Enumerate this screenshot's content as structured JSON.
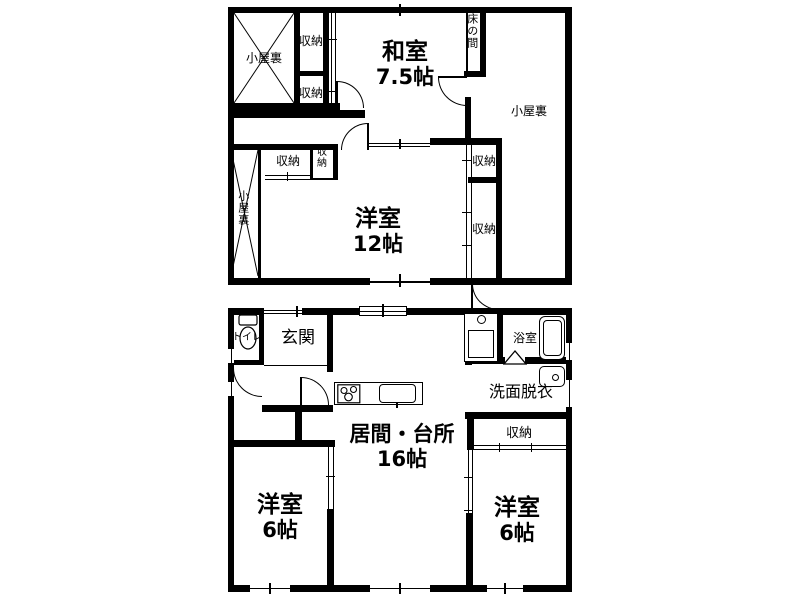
{
  "plan_title": "二階建て住宅間取り図",
  "colors": {
    "line": "#000000",
    "background": "#ffffff"
  },
  "floors": {
    "upper": {
      "attic_top_left": "小屋裏",
      "closet_top_1": "収納",
      "closet_top_2": "収納",
      "washitsu": {
        "label": "和室",
        "size": "7.5帖"
      },
      "tokonoma": "床の間",
      "attic_right": "小屋裏",
      "attic_left": "小屋裏",
      "closet_mid_1": "収納",
      "closet_mid_2": "収納",
      "yoshitsu12": {
        "label": "洋室",
        "size": "12帖"
      },
      "closet_right_1": "収納",
      "closet_right_2": "収納"
    },
    "lower": {
      "toilet": "トイレ",
      "genkan": "玄関",
      "bath": "浴室",
      "senmen_datsui": "洗面脱衣",
      "living_kitchen": {
        "label": "居間・台所",
        "size": "16帖"
      },
      "closet": "収納",
      "yoshitsu_left": {
        "label": "洋室",
        "size": "6帖"
      },
      "yoshitsu_right": {
        "label": "洋室",
        "size": "6帖"
      }
    }
  }
}
